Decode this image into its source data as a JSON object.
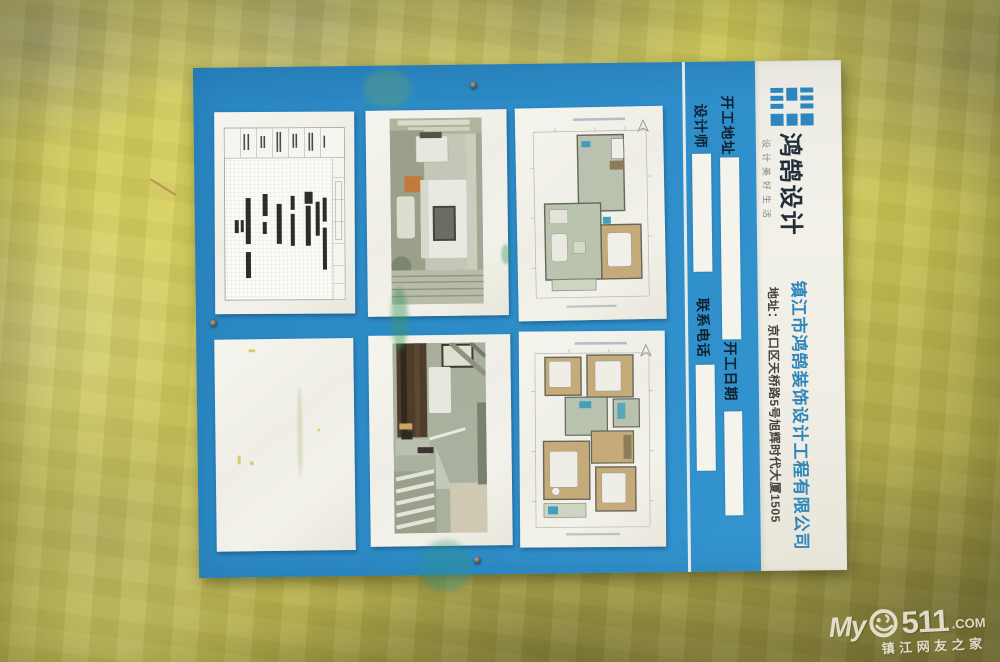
{
  "colors": {
    "board_blue": "#2d8cc7",
    "logo_blue": "#2e86c1",
    "company_text_blue": "#2f86ba",
    "wall_yellow": "#d2cb52",
    "paper_white": "#f2f1e9"
  },
  "board": {
    "brand": {
      "logo_icon": "stripe-bars-logo",
      "name": "鸿鹄设计",
      "slogan": "设计美好生活"
    },
    "company_line": "镇江市鸿鹄装饰设计工程有限公司",
    "address_line": "地址：京口区天桥路5号旭辉时代大厦1505",
    "fields": {
      "site_label": "开工地址",
      "designer_label": "设计师",
      "phone_label": "联系电话",
      "date_label": "开工日期"
    },
    "panels": [
      {
        "kind": "construction-schedule"
      },
      {
        "kind": "interior-rendering"
      },
      {
        "kind": "floor-plan"
      },
      {
        "kind": "blank-sheet"
      },
      {
        "kind": "interior-rendering"
      },
      {
        "kind": "floor-plan"
      }
    ]
  },
  "watermark": {
    "prefix": "My",
    "number": "511",
    "suffix": ".COM",
    "tagline": "镇江网友之家"
  }
}
